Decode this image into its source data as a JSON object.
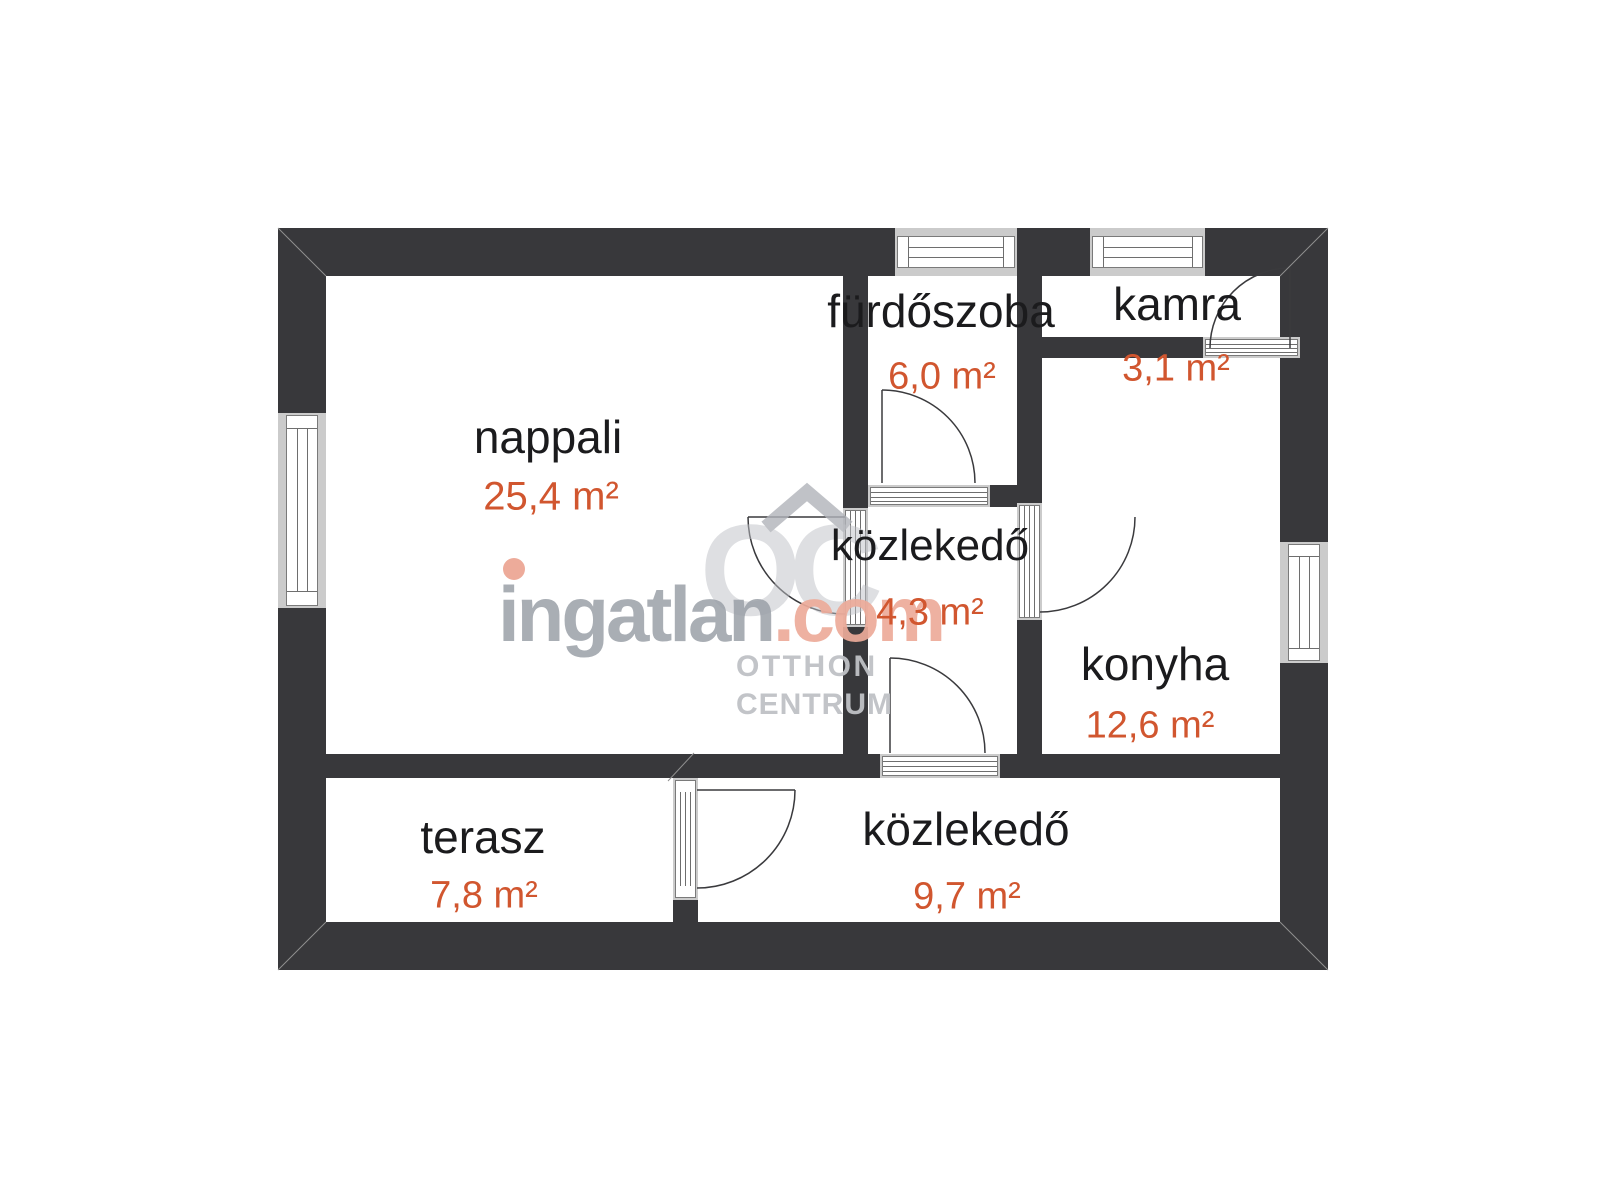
{
  "canvas": {
    "background": "#ffffff"
  },
  "colors": {
    "wall": "#38383b",
    "room_name": "#1b1b1d",
    "area_text": "#d1562f",
    "watermark_gray": "#9ba0a8",
    "watermark_salmon": "#edab9a",
    "logo_gray": "#bfc1c6",
    "canvas_bg": "#ffffff"
  },
  "rooms": [
    {
      "name": "nappali",
      "area": "25,4 m²"
    },
    {
      "name": "fürdőszoba",
      "area": "6,0 m²"
    },
    {
      "name": "kamra",
      "area": "3,1 m²"
    },
    {
      "name": "közlekedő",
      "area": "4,3 m²"
    },
    {
      "name": "konyha",
      "area": "12,6 m²"
    },
    {
      "name": "terasz",
      "area": "7,8 m²"
    },
    {
      "name": "közlekedő",
      "area": "9,7 m²"
    }
  ],
  "watermark": {
    "brand_first_letter": "i",
    "brand_rest": "ngatlan",
    "brand_tld": ".com",
    "logo_monogram": "OC",
    "logo_line1": "OTTHON",
    "logo_line2": "CENTRUM"
  }
}
